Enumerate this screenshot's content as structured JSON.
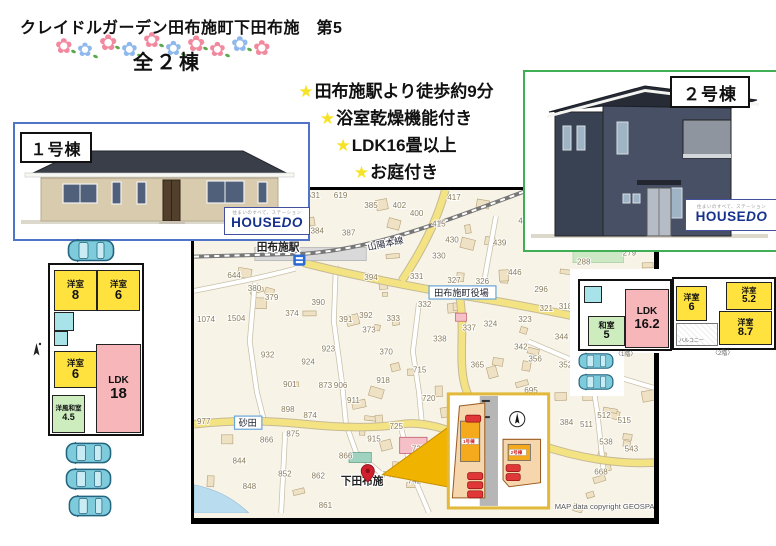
{
  "page_title": "クレイドルガーデン田布施町下田布施　第5",
  "header": {
    "total_label": "全２棟",
    "star_glyph": "★",
    "features": [
      "田布施駅より徒歩約9分",
      "浴室乾燥機能付き",
      "LDK16畳以上",
      "お庭付き"
    ]
  },
  "buildings": {
    "house1": {
      "label": "１号棟",
      "border_color": "#4f74c8"
    },
    "house2": {
      "label": "２号棟",
      "border_color": "#3fae54"
    }
  },
  "brand": {
    "name_house": "HOUSE",
    "name_do": "DO",
    "tagline": "住まいのすべて、ステーション"
  },
  "floorplan1": {
    "rooms": [
      {
        "name": "洋室",
        "size": "8"
      },
      {
        "name": "洋室",
        "size": "6"
      },
      {
        "name": "洋室",
        "size": "6"
      },
      {
        "name": "LDK",
        "size": "18"
      },
      {
        "name": "洋風和室",
        "size": "4.5"
      }
    ]
  },
  "floorplan2": {
    "floor1_caption": "〈1階〉",
    "floor2_caption": "〈2階〉",
    "first_floor": {
      "rooms": [
        {
          "name": "和室",
          "size": "5"
        },
        {
          "name": "LDK",
          "size": "16.2"
        }
      ]
    },
    "second_floor": {
      "rooms": [
        {
          "name": "洋室",
          "size": "6"
        },
        {
          "name": "洋室",
          "size": "5.2"
        },
        {
          "name": "洋室",
          "size": "8.7"
        }
      ],
      "balcony_label": "バルコニー"
    }
  },
  "map": {
    "station_label": "田布施駅",
    "railway_label": "山陽本線",
    "town_hall_label": "田布施町役場",
    "district_label": "砂田",
    "place_label": "下田布施",
    "copyright": "MAP data copyright GEOSPACE",
    "parcel_numbers": [
      {
        "t": "631",
        "x": 111,
        "y": 2
      },
      {
        "t": "619",
        "x": 138,
        "y": 2
      },
      {
        "t": "385",
        "x": 168,
        "y": 12
      },
      {
        "t": "402",
        "x": 196,
        "y": 12
      },
      {
        "t": "400",
        "x": 213,
        "y": 20
      },
      {
        "t": "415",
        "x": 235,
        "y": 30
      },
      {
        "t": "417",
        "x": 250,
        "y": 4
      },
      {
        "t": "384",
        "x": 115,
        "y": 37
      },
      {
        "t": "387",
        "x": 146,
        "y": 39
      },
      {
        "t": "430",
        "x": 248,
        "y": 46
      },
      {
        "t": "330",
        "x": 235,
        "y": 62
      },
      {
        "t": "439",
        "x": 295,
        "y": 49
      },
      {
        "t": "455",
        "x": 320,
        "y": 27
      },
      {
        "t": "446",
        "x": 310,
        "y": 78
      },
      {
        "t": "326",
        "x": 278,
        "y": 87
      },
      {
        "t": "327",
        "x": 250,
        "y": 86
      },
      {
        "t": "331",
        "x": 213,
        "y": 82
      },
      {
        "t": "394",
        "x": 168,
        "y": 83
      },
      {
        "t": "296",
        "x": 336,
        "y": 95
      },
      {
        "t": "288",
        "x": 378,
        "y": 68
      },
      {
        "t": "279",
        "x": 423,
        "y": 59
      },
      {
        "t": "644",
        "x": 33,
        "y": 81
      },
      {
        "t": "380",
        "x": 53,
        "y": 94
      },
      {
        "t": "379",
        "x": 70,
        "y": 103
      },
      {
        "t": "1074",
        "x": 3,
        "y": 125
      },
      {
        "t": "374",
        "x": 90,
        "y": 119
      },
      {
        "t": "1504",
        "x": 33,
        "y": 124
      },
      {
        "t": "390",
        "x": 116,
        "y": 108
      },
      {
        "t": "391",
        "x": 143,
        "y": 125
      },
      {
        "t": "392",
        "x": 163,
        "y": 121
      },
      {
        "t": "333",
        "x": 190,
        "y": 124
      },
      {
        "t": "332",
        "x": 221,
        "y": 110
      },
      {
        "t": "328",
        "x": 240,
        "y": 99
      },
      {
        "t": "337",
        "x": 265,
        "y": 133
      },
      {
        "t": "324",
        "x": 286,
        "y": 129
      },
      {
        "t": "323",
        "x": 320,
        "y": 125
      },
      {
        "t": "318",
        "x": 360,
        "y": 112
      },
      {
        "t": "321",
        "x": 341,
        "y": 114
      },
      {
        "t": "344",
        "x": 356,
        "y": 142
      },
      {
        "t": "342",
        "x": 316,
        "y": 152
      },
      {
        "t": "356",
        "x": 330,
        "y": 164
      },
      {
        "t": "352",
        "x": 360,
        "y": 170
      },
      {
        "t": "365",
        "x": 273,
        "y": 170
      },
      {
        "t": "338",
        "x": 236,
        "y": 144
      },
      {
        "t": "370",
        "x": 183,
        "y": 157
      },
      {
        "t": "373",
        "x": 166,
        "y": 135
      },
      {
        "t": "923",
        "x": 126,
        "y": 154
      },
      {
        "t": "932",
        "x": 66,
        "y": 160
      },
      {
        "t": "924",
        "x": 106,
        "y": 167
      },
      {
        "t": "715",
        "x": 216,
        "y": 175
      },
      {
        "t": "918",
        "x": 180,
        "y": 185
      },
      {
        "t": "901",
        "x": 88,
        "y": 189
      },
      {
        "t": "873",
        "x": 123,
        "y": 190
      },
      {
        "t": "906",
        "x": 138,
        "y": 190
      },
      {
        "t": "911",
        "x": 151,
        "y": 205
      },
      {
        "t": "720",
        "x": 225,
        "y": 203
      },
      {
        "t": "695",
        "x": 326,
        "y": 195
      },
      {
        "t": "898",
        "x": 86,
        "y": 214
      },
      {
        "t": "874",
        "x": 108,
        "y": 220
      },
      {
        "t": "725",
        "x": 193,
        "y": 231
      },
      {
        "t": "915",
        "x": 171,
        "y": 243
      },
      {
        "t": "875",
        "x": 91,
        "y": 238
      },
      {
        "t": "866",
        "x": 65,
        "y": 244
      },
      {
        "t": "727",
        "x": 215,
        "y": 253
      },
      {
        "t": "866",
        "x": 143,
        "y": 260
      },
      {
        "t": "844",
        "x": 38,
        "y": 265
      },
      {
        "t": "852",
        "x": 83,
        "y": 278
      },
      {
        "t": "862",
        "x": 116,
        "y": 280
      },
      {
        "t": "743",
        "x": 186,
        "y": 279
      },
      {
        "t": "742",
        "x": 211,
        "y": 285
      },
      {
        "t": "848",
        "x": 48,
        "y": 290
      },
      {
        "t": "861",
        "x": 123,
        "y": 309
      },
      {
        "t": "512",
        "x": 398,
        "y": 220
      },
      {
        "t": "515",
        "x": 418,
        "y": 225
      },
      {
        "t": "511",
        "x": 381,
        "y": 229
      },
      {
        "t": "538",
        "x": 400,
        "y": 246
      },
      {
        "t": "543",
        "x": 425,
        "y": 253
      },
      {
        "t": "668",
        "x": 395,
        "y": 276
      },
      {
        "t": "384",
        "x": 361,
        "y": 227
      },
      {
        "t": "977",
        "x": 3,
        "y": 226
      }
    ]
  },
  "site_inset": {
    "lot1_label": "1号棟",
    "lot2_label": "2号棟"
  },
  "colors": {
    "star": "#f6e327",
    "map_arrow": "#f0b400",
    "pin": "#d0202e",
    "car": "#7ecbdc",
    "room_yellow": "#ffe23e",
    "room_pink": "#f7b6ba",
    "room_green": "#cdedbf",
    "bath_teal": "#a8e3ea"
  },
  "flowers": [
    {
      "c": "#f2899e",
      "x": 0,
      "y": 8,
      "s": 21
    },
    {
      "c": "#8fb8ec",
      "x": 22,
      "y": 13,
      "s": 19
    },
    {
      "c": "#f2899e",
      "x": 44,
      "y": 4,
      "s": 22
    },
    {
      "c": "#8fb8ec",
      "x": 66,
      "y": 12,
      "s": 20
    },
    {
      "c": "#f2899e",
      "x": 88,
      "y": 2,
      "s": 21
    },
    {
      "c": "#8fb8ec",
      "x": 110,
      "y": 11,
      "s": 20
    },
    {
      "c": "#f2899e",
      "x": 132,
      "y": 5,
      "s": 22
    },
    {
      "c": "#f2899e",
      "x": 154,
      "y": 12,
      "s": 20
    },
    {
      "c": "#8fb8ec",
      "x": 176,
      "y": 6,
      "s": 21
    },
    {
      "c": "#f2899e",
      "x": 198,
      "y": 10,
      "s": 21
    }
  ]
}
